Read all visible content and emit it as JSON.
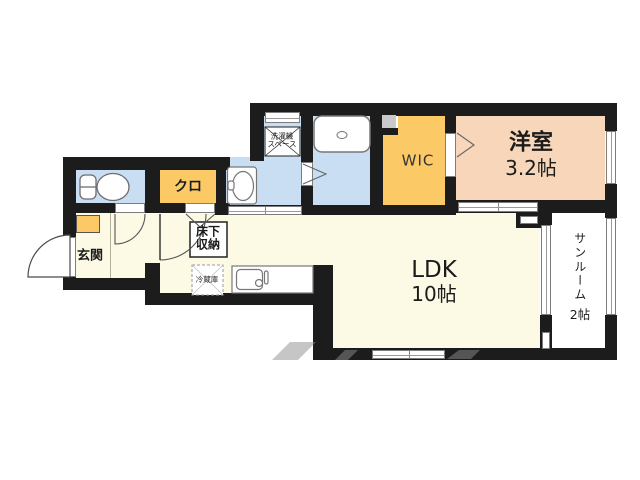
{
  "rooms": {
    "genkan": {
      "label": "玄関"
    },
    "kuro": {
      "label": "クロ"
    },
    "washer_space": {
      "line1": "洗濯機",
      "line2": "スペース"
    },
    "wic": {
      "label": "WIC"
    },
    "youshitsu": {
      "name": "洋室",
      "size": "3.2帖"
    },
    "ldk": {
      "name": "LDK",
      "size": "10帖"
    },
    "sunroom": {
      "name": "サンルーム",
      "size": "2帖"
    },
    "underfloor_storage": {
      "line1": "床下",
      "line2": "収納"
    },
    "fridge": {
      "label": "冷蔵庫"
    }
  },
  "colors": {
    "wall": "#1c1c1c",
    "wet_area": "#c9def2",
    "storage": "#fbca67",
    "living": "#fcf9e4",
    "bedroom": "#f7d6ba",
    "sunroom": "#ffffff"
  }
}
